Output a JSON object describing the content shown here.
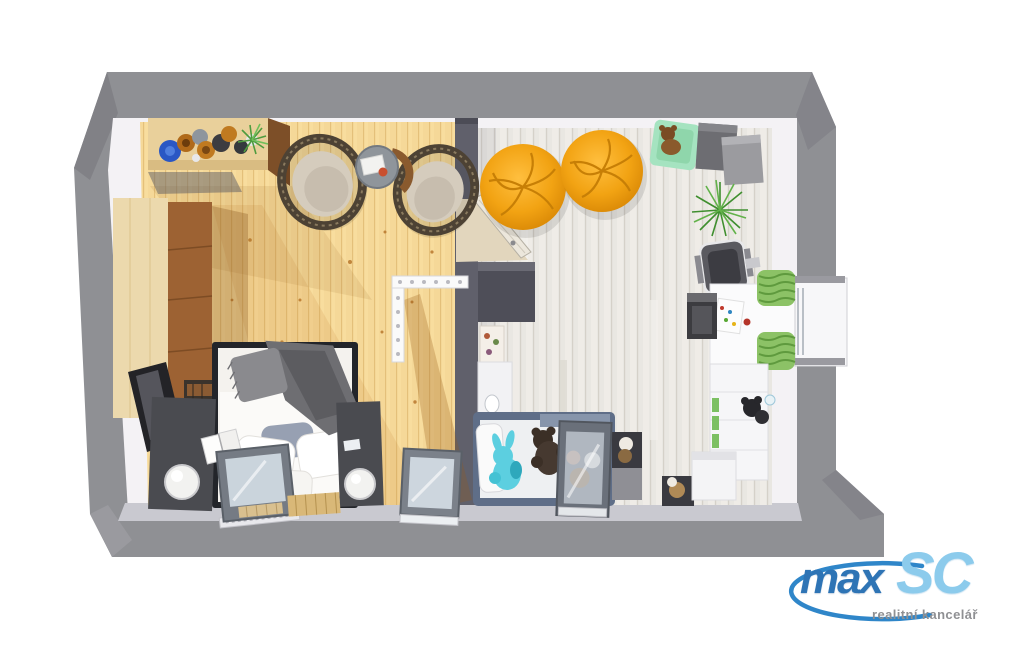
{
  "image": {
    "kind": "3d-floor-plan-top-down-render",
    "description": "Top-down 3D render of an attic flat with a pine-floor bedroom (left) and a whitewashed-floor kids room (right), thick grey sloped walls with roof windows",
    "background": "#ffffff",
    "wall_color": "#8f9094"
  },
  "floorplan": {
    "rooms": [
      {
        "id": "bedroom",
        "floor_style": "warm pine planks",
        "floor_color": "#f8dd9e",
        "furniture": [
          "sideboard-with-bowls",
          "decor-bowls",
          "potted-plant",
          "wardrobe",
          "rattan-chair",
          "rattan-chair",
          "round-side-table",
          "stair-railing",
          "double-bed",
          "gray-blanket",
          "pillows",
          "nightstand",
          "nightstand",
          "sphere-lamp",
          "sphere-lamp",
          "open-book",
          "bookshelf",
          "leaning-panel",
          "roof-window",
          "roof-window",
          "wood-slat-mat"
        ]
      },
      {
        "id": "kids-room",
        "floor_style": "whitewashed wood planks",
        "floor_color": "#e9e7e2",
        "furniture": [
          "open-door",
          "bean-bag",
          "bean-bag",
          "mint-pouf",
          "teddy-bear",
          "storage-cube",
          "storage-cube",
          "potted-fern",
          "office-chair",
          "desk",
          "computer-tower",
          "dormer-window-green-curtains",
          "shelving-unit",
          "plush-toy-black",
          "kids-bed",
          "plush-bunny",
          "plush-teddy",
          "roof-window",
          "toy-cubes",
          "white-storage-box",
          "dark-wardrobe",
          "poster",
          "wash-basin"
        ]
      }
    ],
    "accent_colors": {
      "bean_bag": "#f2a313",
      "mint": "#a5e3c0",
      "curtain_green": "#8cc266",
      "kids_bed_frame": "#5f6e88",
      "turquoise_plush": "#5ccfe0"
    }
  },
  "logo": {
    "brand_part1": "max",
    "brand_part2": "SC",
    "tagline": "realitní kancelář",
    "part1_color": "#2e74b5",
    "part2_color": "#8ccbec",
    "swoosh_color": "#2f86c9",
    "tagline_color": "#8f9093"
  }
}
